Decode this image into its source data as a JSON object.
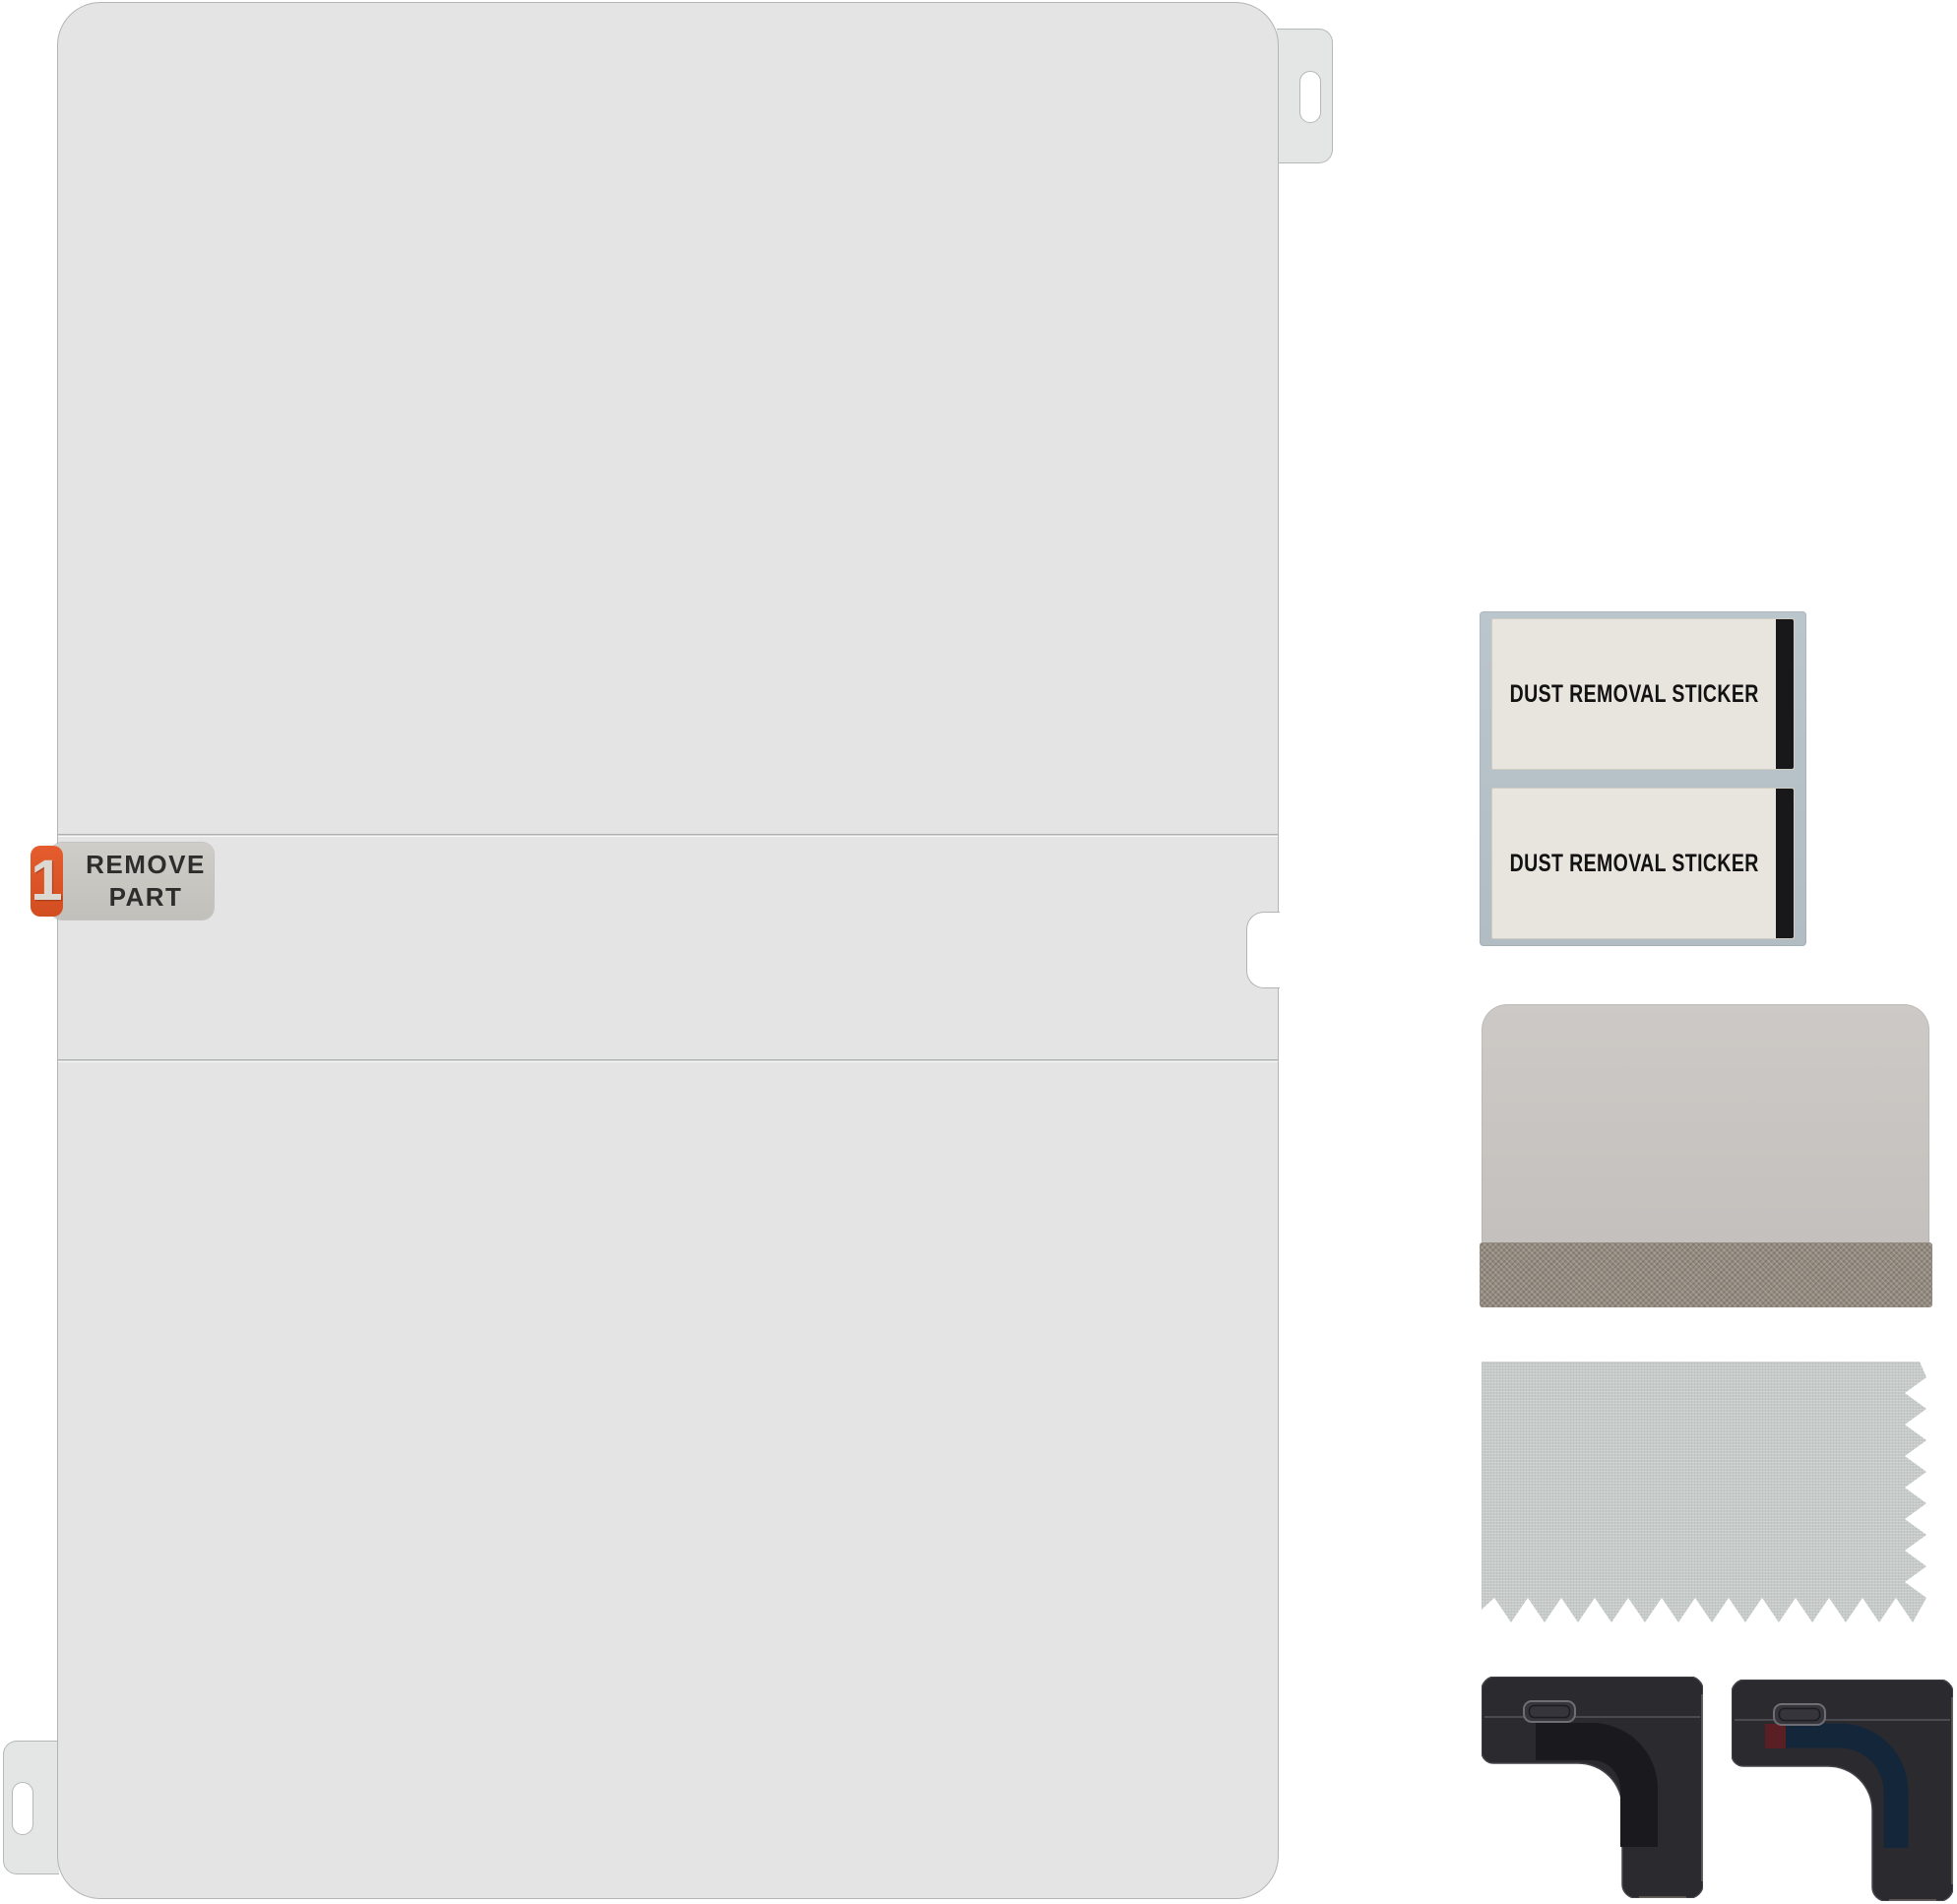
{
  "background_color": "#ffffff",
  "film": {
    "color": "#e4e4e4",
    "edge_color": "#b2b5b5",
    "step_badge": {
      "number": "1",
      "line1": "REMOVE",
      "line2": "PART",
      "tab_color": "#de5628",
      "plate_color": "#c8c6c1",
      "text_color": "#2d2d2b"
    }
  },
  "sticker_sheet": {
    "backing_color": "#b7c2c8",
    "sticker_color": "#e8e5de",
    "strip_color": "#18181b",
    "stickers": [
      {
        "label": "DUST REMOVAL STICKER"
      },
      {
        "label": "DUST REMOVAL STICKER"
      }
    ]
  },
  "squeegee": {
    "body_color": "#c8c4c1",
    "felt_color": "#948b80"
  },
  "cloth": {
    "color": "#c6cbc9"
  },
  "corner_guides": {
    "body_color": "#2b2a2e",
    "left": {
      "inlay_color": "#1a191d"
    },
    "right": {
      "inlay_color": "#14263a",
      "mark_color": "#5a1e25"
    }
  }
}
